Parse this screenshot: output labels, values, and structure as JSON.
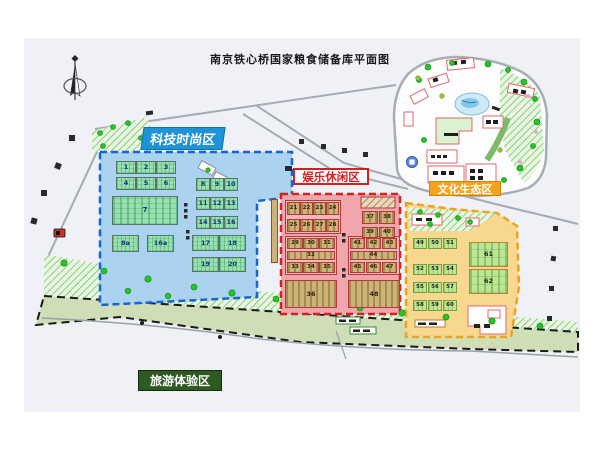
{
  "title": "南京铁心桥国家粮食储备库平面图",
  "zones": {
    "tech": {
      "label": "科技时尚区",
      "accent_color": "#1e93d7",
      "fill_color": "#abd2ef",
      "buildings": [
        "1",
        "2",
        "3",
        "4",
        "5",
        "6",
        "7",
        "8",
        "9",
        "10",
        "11",
        "12",
        "13",
        "14",
        "15",
        "16",
        "8a",
        "16a",
        "17",
        "18",
        "19",
        "20"
      ]
    },
    "entertainment": {
      "label": "娱乐休闲区",
      "accent_color": "#d42020",
      "fill_color": "#f1a6ad",
      "buildings": [
        "21",
        "22",
        "23",
        "24",
        "25",
        "26",
        "27",
        "28",
        "29",
        "30",
        "31",
        "32",
        "33",
        "34",
        "35",
        "36",
        "37",
        "38",
        "39",
        "40",
        "41",
        "42",
        "43",
        "44",
        "45",
        "46",
        "47",
        "48"
      ]
    },
    "culture": {
      "label": "文化生态区",
      "accent_color": "#f5a31e",
      "fill_color": "#f7d88e",
      "buildings": [
        "49",
        "50",
        "51",
        "52",
        "53",
        "54",
        "55",
        "56",
        "57",
        "58",
        "59",
        "60",
        "61",
        "62"
      ]
    },
    "tourism": {
      "label": "旅游体验区",
      "accent_color": "#2e5a22",
      "fill_color": "#d0deb8"
    }
  },
  "map": {
    "compass": "north-arrow",
    "park_pond": "pond",
    "road_color": "#a6abb1"
  }
}
